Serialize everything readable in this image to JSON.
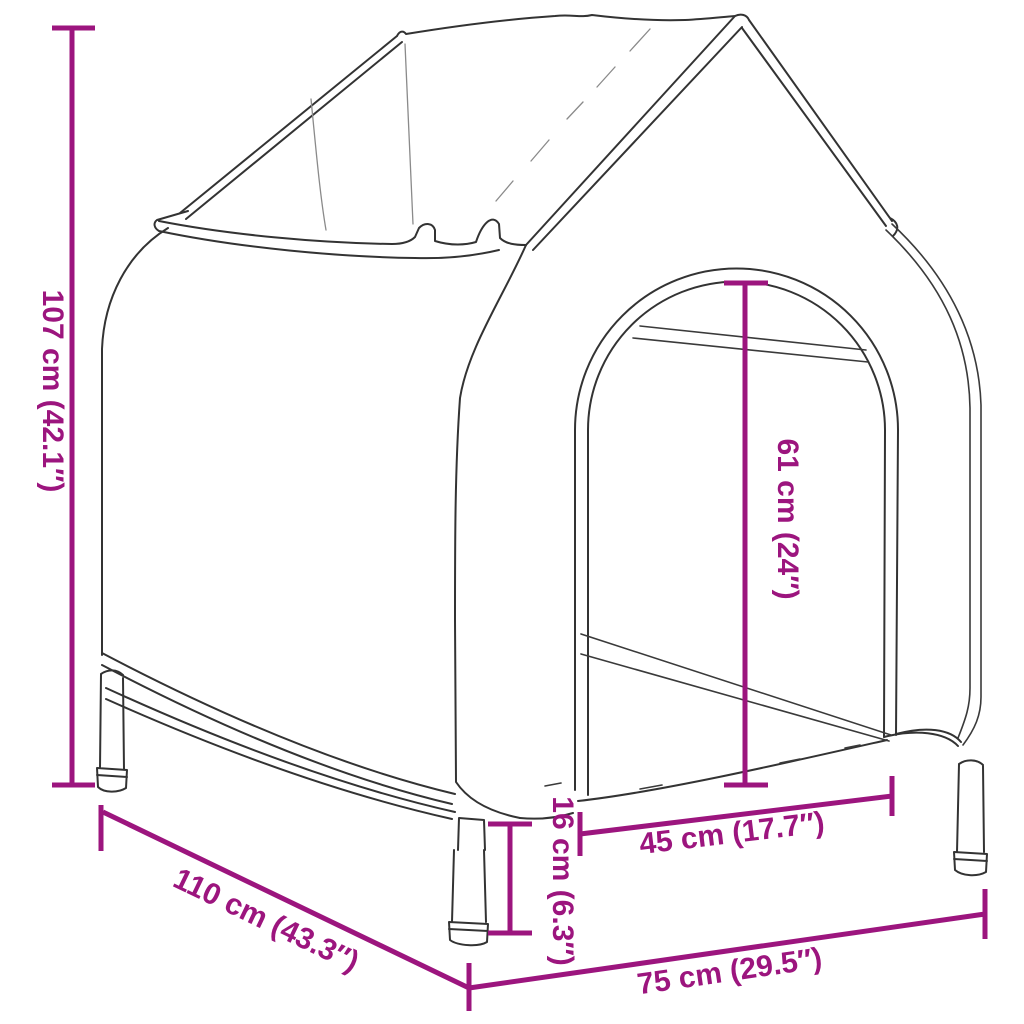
{
  "title": "Elevated fabric dog house dimension diagram",
  "colors": {
    "dimension": "#9C157E",
    "line": "#333333",
    "background": "#ffffff"
  },
  "dimensions": {
    "height": {
      "label": "107 cm (42.1″)",
      "cm": "107",
      "inches": "42.1″"
    },
    "depth": {
      "label": "110 cm (43.3″)",
      "cm": "110",
      "inches": "43.3″"
    },
    "width": {
      "label": "75 cm (29.5″)",
      "cm": "75",
      "inches": "29.5″"
    },
    "door_height": {
      "label": "61 cm (24″)",
      "cm": "61",
      "inches": "24″"
    },
    "door_width": {
      "label": "45 cm (17.7″)",
      "cm": "45",
      "inches": "17.7″"
    },
    "base_height": {
      "label": "16 cm (6.3″)",
      "cm": "16",
      "inches": "6.3″"
    }
  }
}
